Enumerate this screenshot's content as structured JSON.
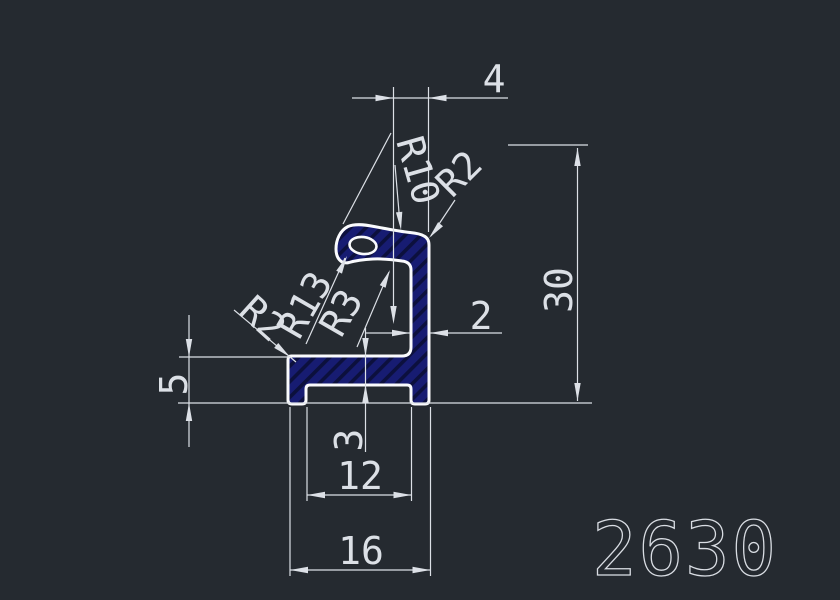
{
  "drawing": {
    "part_number": "2630",
    "type": "extrusion-profile-section",
    "colors": {
      "background": "#252A30",
      "dimension_lines": "#DCE0E6",
      "profile_outline": "#FAFBFD",
      "profile_fill_navy": "#171C72",
      "profile_hatch_dark": "#0C103D"
    },
    "linear_dims": [
      {
        "name": "top-offset",
        "label": "4"
      },
      {
        "name": "overall-height",
        "label": "30"
      },
      {
        "name": "base-height",
        "label": "5"
      },
      {
        "name": "web-thickness",
        "label": "3"
      },
      {
        "name": "inner-width",
        "label": "12"
      },
      {
        "name": "overall-width",
        "label": "16"
      },
      {
        "name": "wall-thickness",
        "label": "2"
      }
    ],
    "radius_dims": [
      {
        "name": "hook-outer-radius",
        "label": "R10"
      },
      {
        "name": "hook-corner-radius",
        "label": "R2"
      },
      {
        "name": "base-corner-radius",
        "label": "R2"
      },
      {
        "name": "hook-inner-radius",
        "label": "R13"
      },
      {
        "name": "cavity-fillet-radius",
        "label": "R3"
      }
    ]
  }
}
